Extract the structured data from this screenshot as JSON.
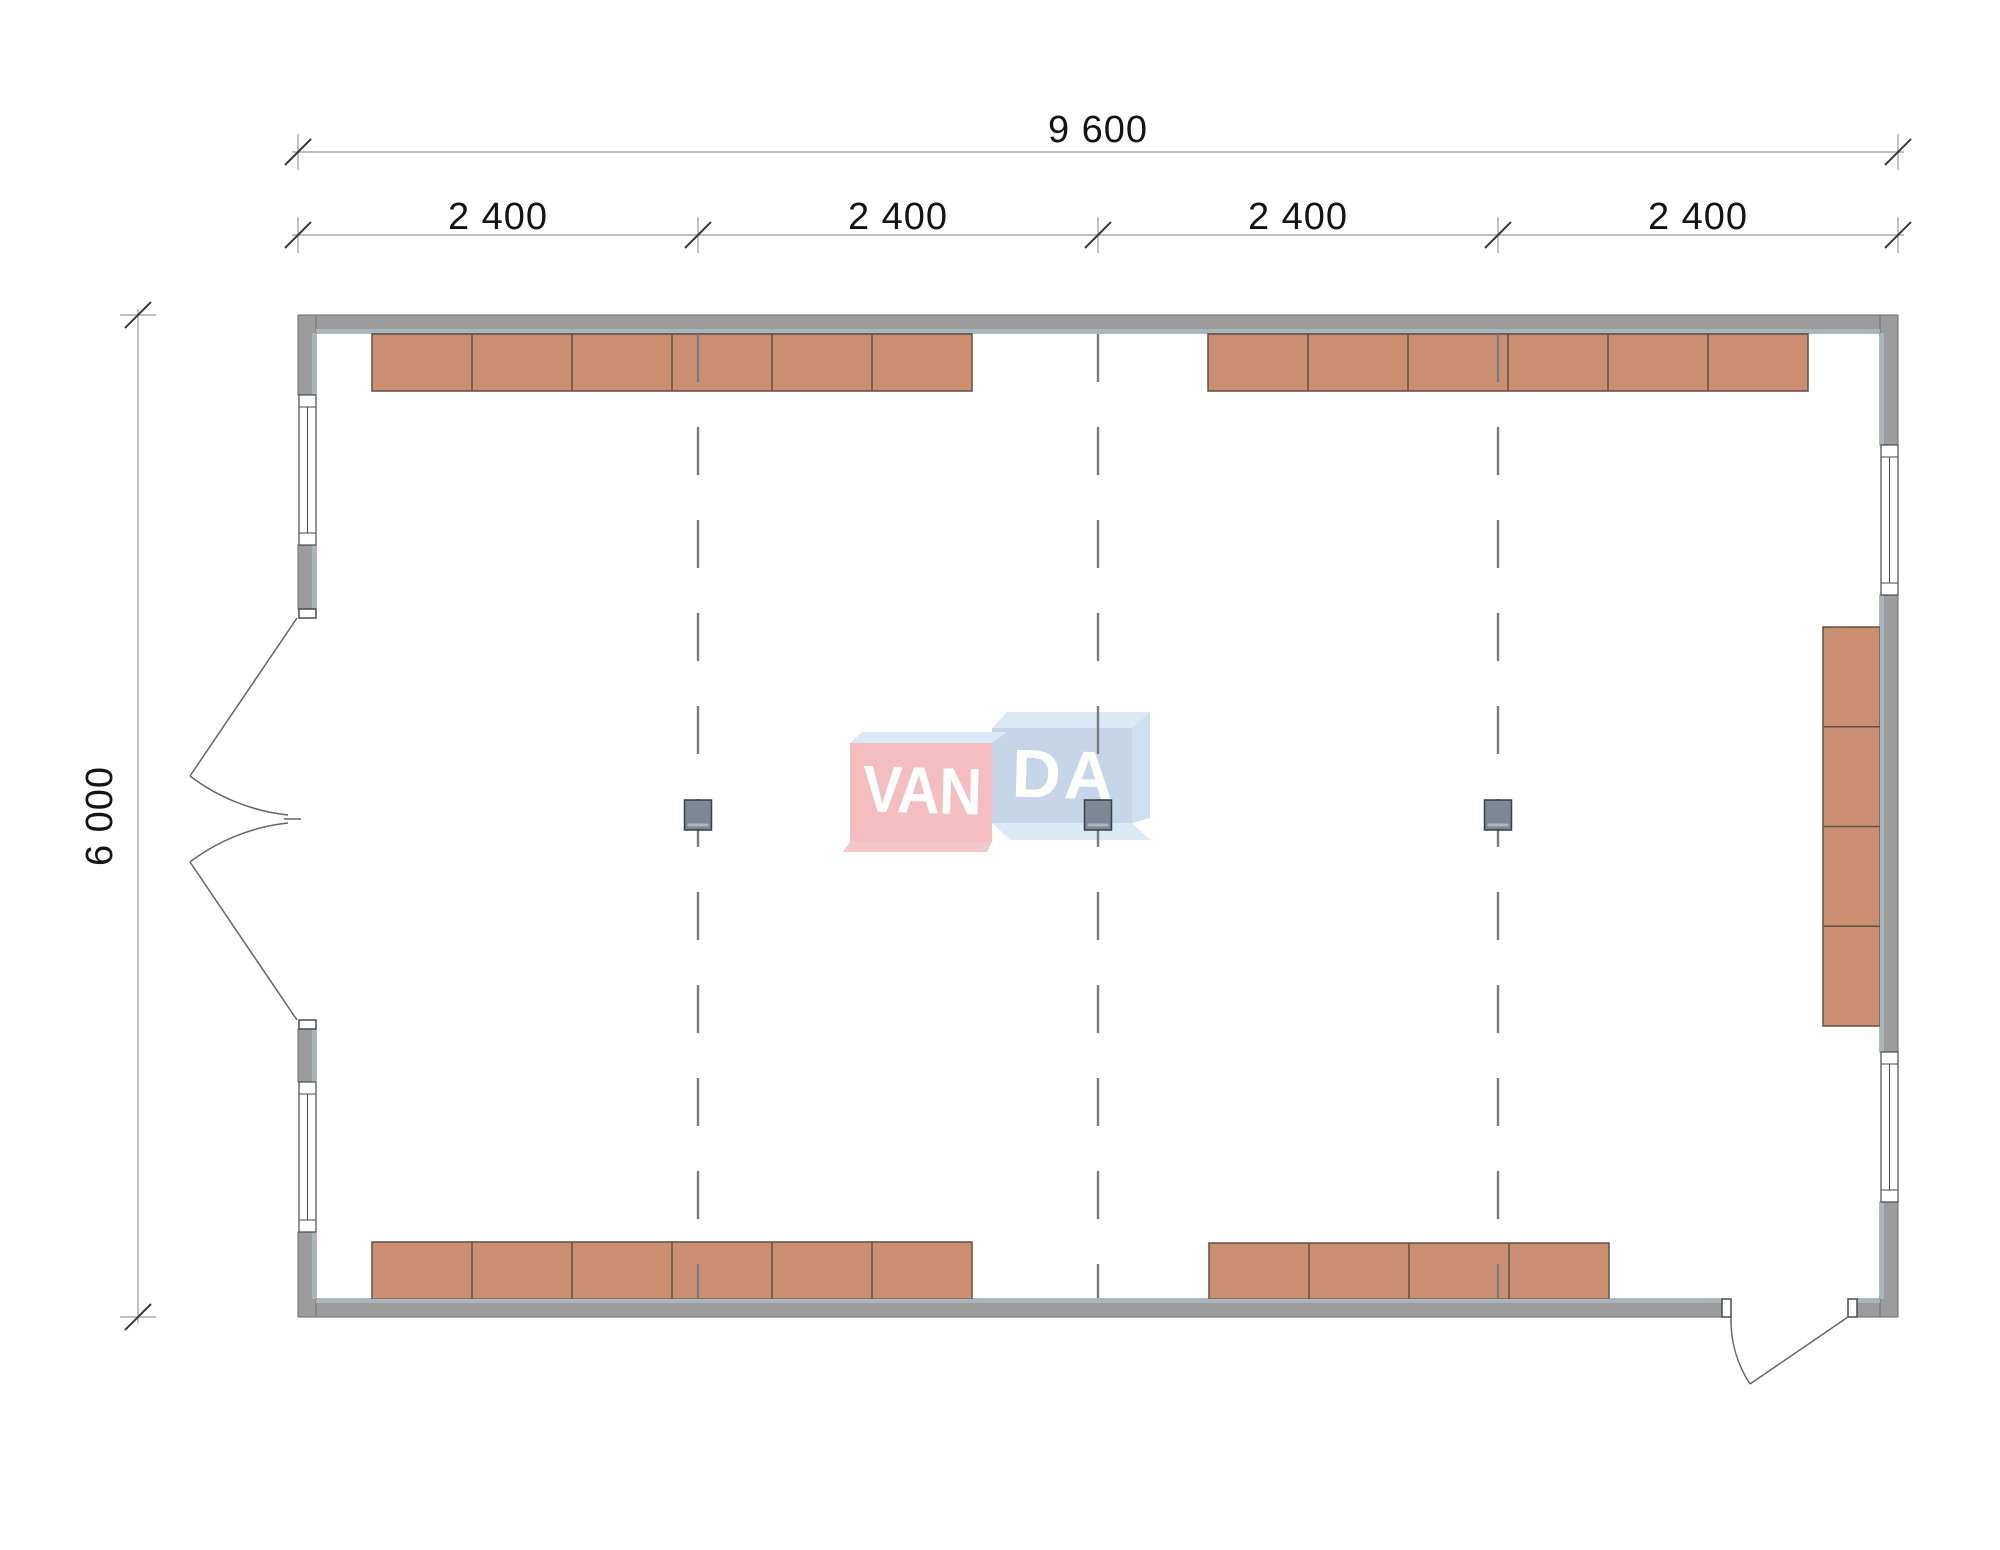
{
  "drawing": {
    "type": "architectural floor plan, single rectangular room",
    "overall_width": "9 600",
    "overall_depth": "6 000",
    "bay_spacing": "2 400"
  },
  "dimension_labels": {
    "total_width": "9 600",
    "bays": [
      "2 400",
      "2 400",
      "2 400",
      "2 400"
    ],
    "total_height": "6 000"
  },
  "watermark": {
    "left": "VAN",
    "right": "DA"
  },
  "colors": {
    "wall": "#9c9c9c",
    "wall_outline": "#6e6e6e",
    "lining": "#a9b7bd",
    "furniture": "#cb8e71",
    "furniture_outline": "#5f5148",
    "window_stroke": "#4a4a4a",
    "door_stroke": "#666666",
    "grid_line": "#7b7b7b",
    "column_fill": "#7d8795",
    "column_stroke": "#3a3f48",
    "column_hatch": "#aeb6bf",
    "dim_line": "#9a9a9a",
    "dim_slash": "#3a3a3a",
    "dim_text": "#141414",
    "wm_pink": "#f4bdc0",
    "wm_pink_soft": "#f3c6c9",
    "wm_blue": "#c6d5e7",
    "wm_blue_soft": "#cfdfee",
    "wm_blue_light": "#d9eaf6",
    "wm_text": "#ffffff"
  },
  "plan": {
    "furniture_groups": [
      {
        "name": "top-wall-left-cabinets",
        "x": 372,
        "y": 334,
        "w": 600,
        "h": 57,
        "units": 6,
        "dir": "h"
      },
      {
        "name": "top-wall-right-cabinets",
        "x": 1208,
        "y": 334,
        "w": 600,
        "h": 57,
        "units": 6,
        "dir": "h"
      },
      {
        "name": "bottom-wall-left-cabinets",
        "x": 372,
        "y": 1242,
        "w": 600,
        "h": 57,
        "units": 6,
        "dir": "h"
      },
      {
        "name": "bottom-wall-right-cabinets",
        "x": 1209,
        "y": 1243,
        "w": 400,
        "h": 56,
        "units": 4,
        "dir": "h"
      },
      {
        "name": "right-wall-cabinets",
        "x": 1823,
        "y": 627,
        "w": 57,
        "h": 399,
        "units": 4,
        "dir": "v"
      }
    ],
    "grid_lines_x": [
      698,
      1098,
      1498
    ],
    "grid_y_top": 334,
    "grid_y_bottom": 1298,
    "columns": [
      {
        "x": 698,
        "y": 800
      },
      {
        "x": 1098,
        "y": 800
      },
      {
        "x": 1498,
        "y": 800
      }
    ],
    "column_size": {
      "w": 27,
      "h": 30
    },
    "windows": [
      {
        "name": "left-wall-window-top",
        "x": 299,
        "y": 395,
        "w": 17,
        "h": 150
      },
      {
        "name": "left-wall-window-bottom",
        "x": 299,
        "y": 1082,
        "w": 17,
        "h": 150
      },
      {
        "name": "right-wall-window-top",
        "x": 1881,
        "y": 445,
        "w": 17,
        "h": 150
      },
      {
        "name": "right-wall-window-bottom",
        "x": 1881,
        "y": 1052,
        "w": 17,
        "h": 150
      }
    ],
    "h_dims": [
      {
        "y": 152,
        "x1": 298,
        "x2": 1898,
        "ticks": [
          298,
          1898
        ]
      },
      {
        "y": 235,
        "x1": 298,
        "x2": 1898,
        "ticks": [
          298,
          698,
          1098,
          1498,
          1898
        ]
      }
    ],
    "v_dims": [
      {
        "x": 138,
        "y1": 315,
        "y2": 1317,
        "ticks": [
          315,
          1317
        ]
      }
    ]
  }
}
